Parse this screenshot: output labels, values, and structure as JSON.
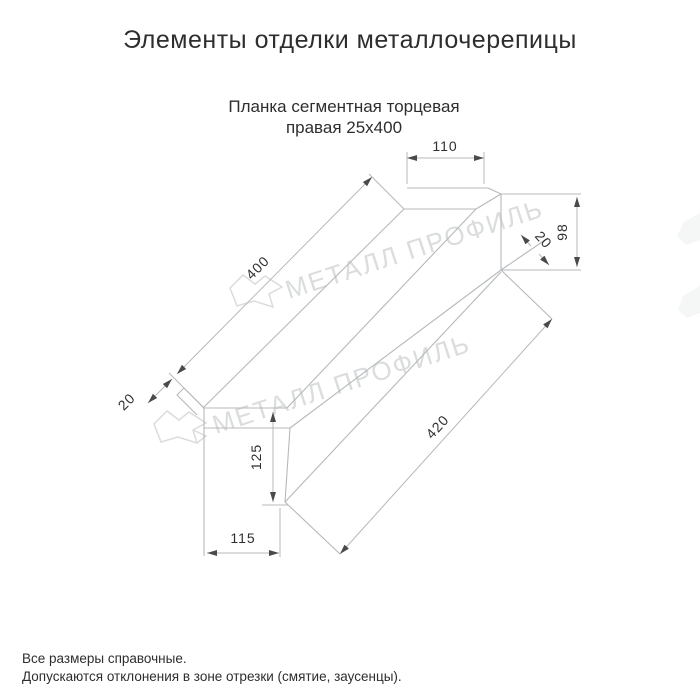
{
  "title": "Элементы отделки металлочерепицы",
  "subtitle": {
    "line1": "Планка сегментная торцевая",
    "line2": "правая 25х400"
  },
  "drawing": {
    "watermark_text": "МЕТАЛЛ ПРОФИЛЬ",
    "dims": {
      "flange_width": "110",
      "end_height": "98",
      "end_hem": "20",
      "top_length": "400",
      "bottom_length": "420",
      "side_hem": "20",
      "face_height": "125",
      "bottom_width": "115"
    }
  },
  "footer": {
    "line1": "Все размеры справочные.",
    "line2": "Допускаются отклонения в зоне отрезки (смятие, заусенцы)."
  },
  "colors": {
    "line": "#b5b9bc",
    "text": "#2f2f2f",
    "arrow": "#4a4a4a",
    "watermark": "#dadcdd"
  }
}
